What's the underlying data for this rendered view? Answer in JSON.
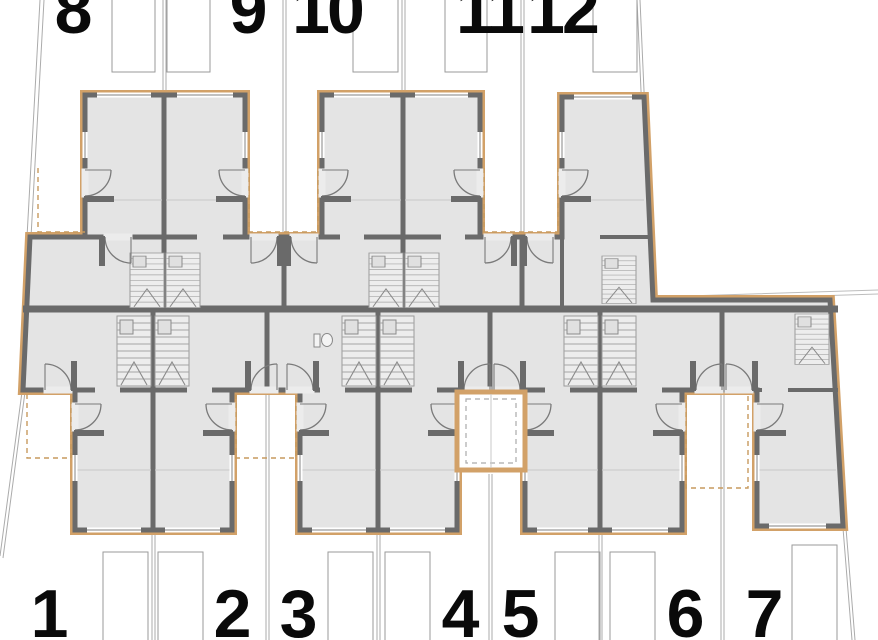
{
  "plan": {
    "type": "architectural-floor-plan",
    "colors": {
      "room_fill": "#e4e4e4",
      "wall": "#6a6a6a",
      "accent_trim": "#d2a168",
      "lot_line": "#ababab",
      "label_color": "#0a0a0a"
    },
    "upper_row_units": [
      {
        "number": "8"
      },
      {
        "number": "9"
      },
      {
        "number": "10"
      },
      {
        "number": "11"
      },
      {
        "number": "12"
      }
    ],
    "lower_row_units": [
      {
        "number": "1"
      },
      {
        "number": "2"
      },
      {
        "number": "3"
      },
      {
        "number": "4"
      },
      {
        "number": "5"
      },
      {
        "number": "6"
      },
      {
        "number": "7"
      }
    ]
  }
}
